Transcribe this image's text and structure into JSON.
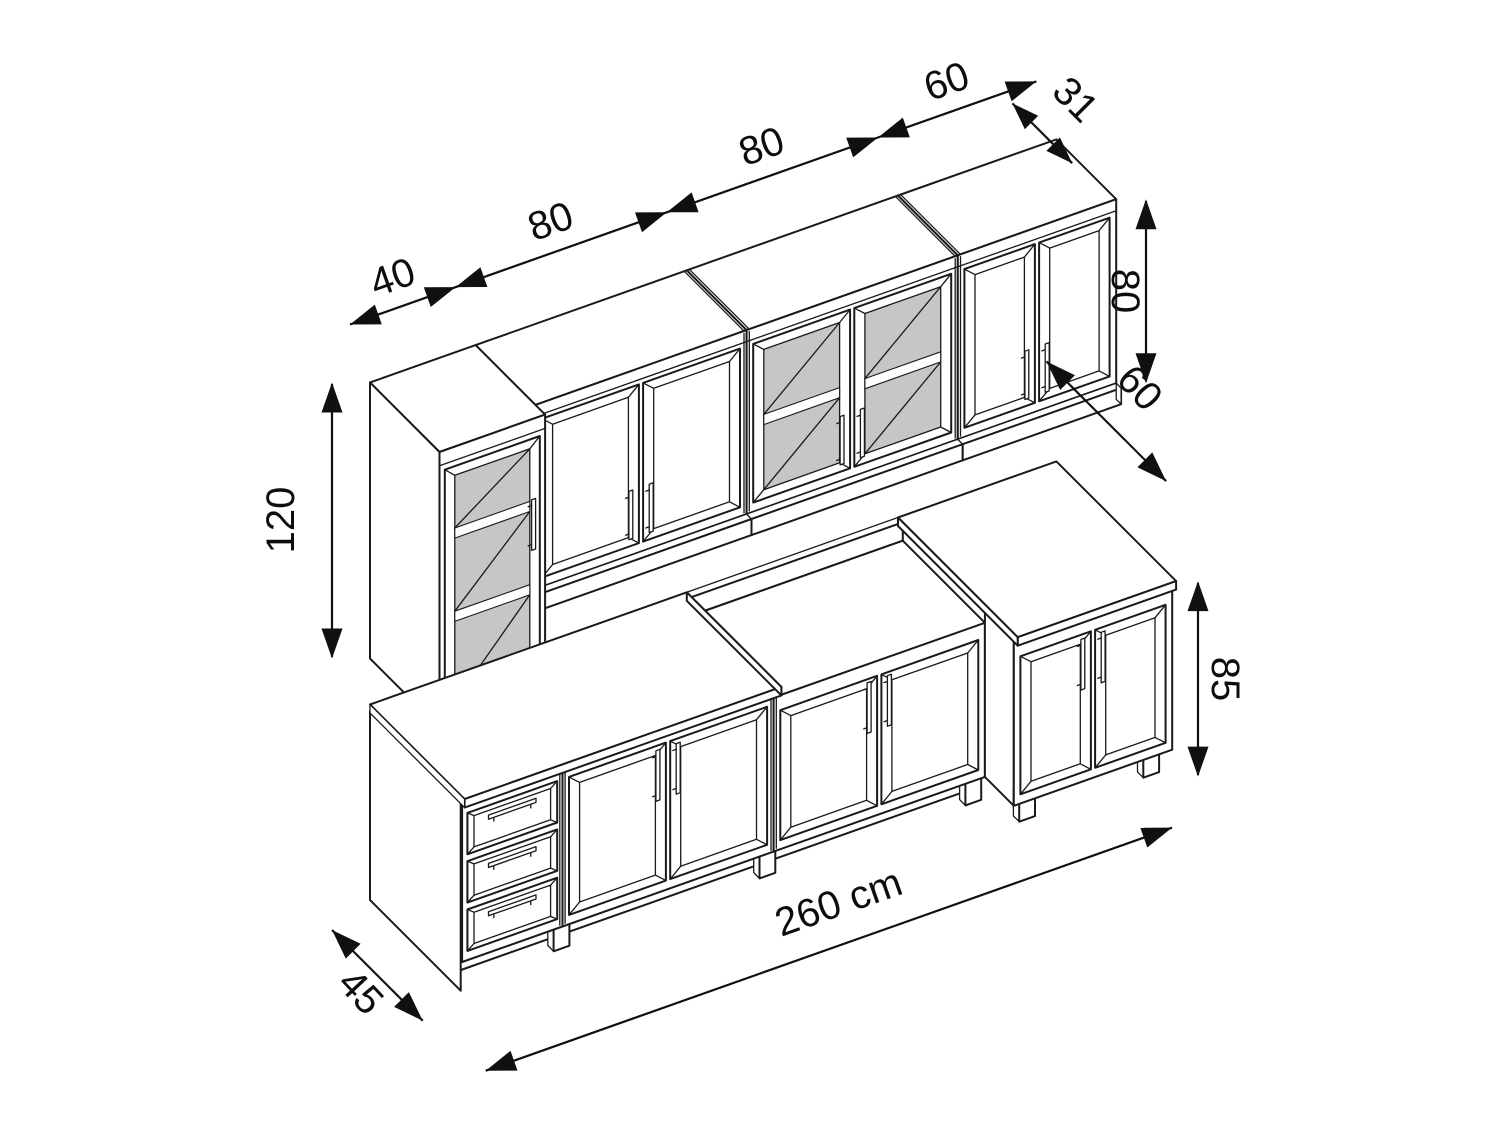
{
  "figure": {
    "kind": "isometric dimensioned line drawing",
    "subject": "kitchen cabinet set: wall cabinets, tall glass display cabinet, base cabinets with worktops",
    "unit": "cm",
    "colors": {
      "background": "#ffffff",
      "line": "#1a1a1a",
      "glass": "#c6c6c8",
      "dimension": "#101010"
    }
  },
  "dims": {
    "w_tall": "40",
    "w_cab1": "80",
    "w_cab2": "80",
    "w_cab3": "60",
    "depth_wall": "31",
    "h_wall": "80",
    "h_tall": "120",
    "depth_worktop": "60",
    "h_base": "85",
    "depth_base": "45",
    "total": "260 cm"
  },
  "components": {
    "wall_row": [
      "tall glass-door display cabinet 40 wide x 120 high with 2 shelves",
      "two-door wall cabinet 80 wide x 80 high",
      "two-glass-door wall cabinet 80 wide x 80 high with shelf",
      "two-door wall cabinet 60 wide x 80 high"
    ],
    "base_row": [
      "three-drawer base unit 40 wide",
      "two-door base cabinet 80 wide under worktop",
      "two-door base cabinet 80 wide with open worktop recess",
      "two-door base unit 60 wide with 60 cm deep worktop"
    ]
  }
}
